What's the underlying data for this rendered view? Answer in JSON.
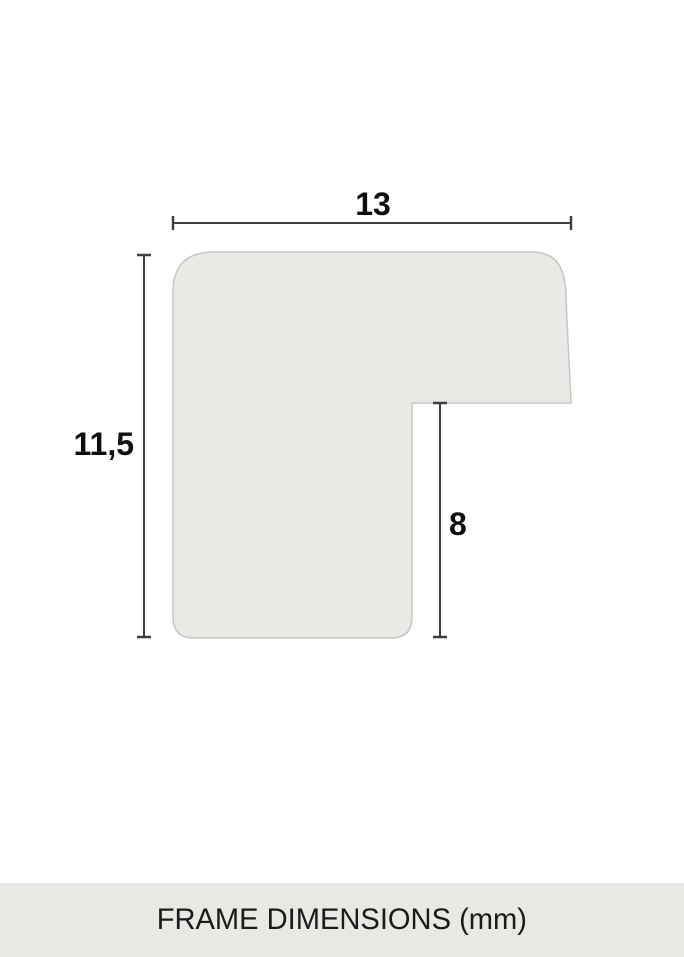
{
  "diagram": {
    "type": "frame-profile-cross-section",
    "labels": {
      "width": "13",
      "height": "11,5",
      "rabbet_depth": "8"
    },
    "units": "mm",
    "colors": {
      "background": "#ffffff",
      "profile_fill": "#e9eae6",
      "profile_stroke": "#c6c7c3",
      "dimension_line": "#3f3f3f",
      "label_text": "#0f0f0f",
      "footer_bg": "#e8e9e4",
      "footer_text": "#1b1b1b"
    }
  },
  "footer": {
    "caption": "FRAME DIMENSIONS (mm)"
  }
}
